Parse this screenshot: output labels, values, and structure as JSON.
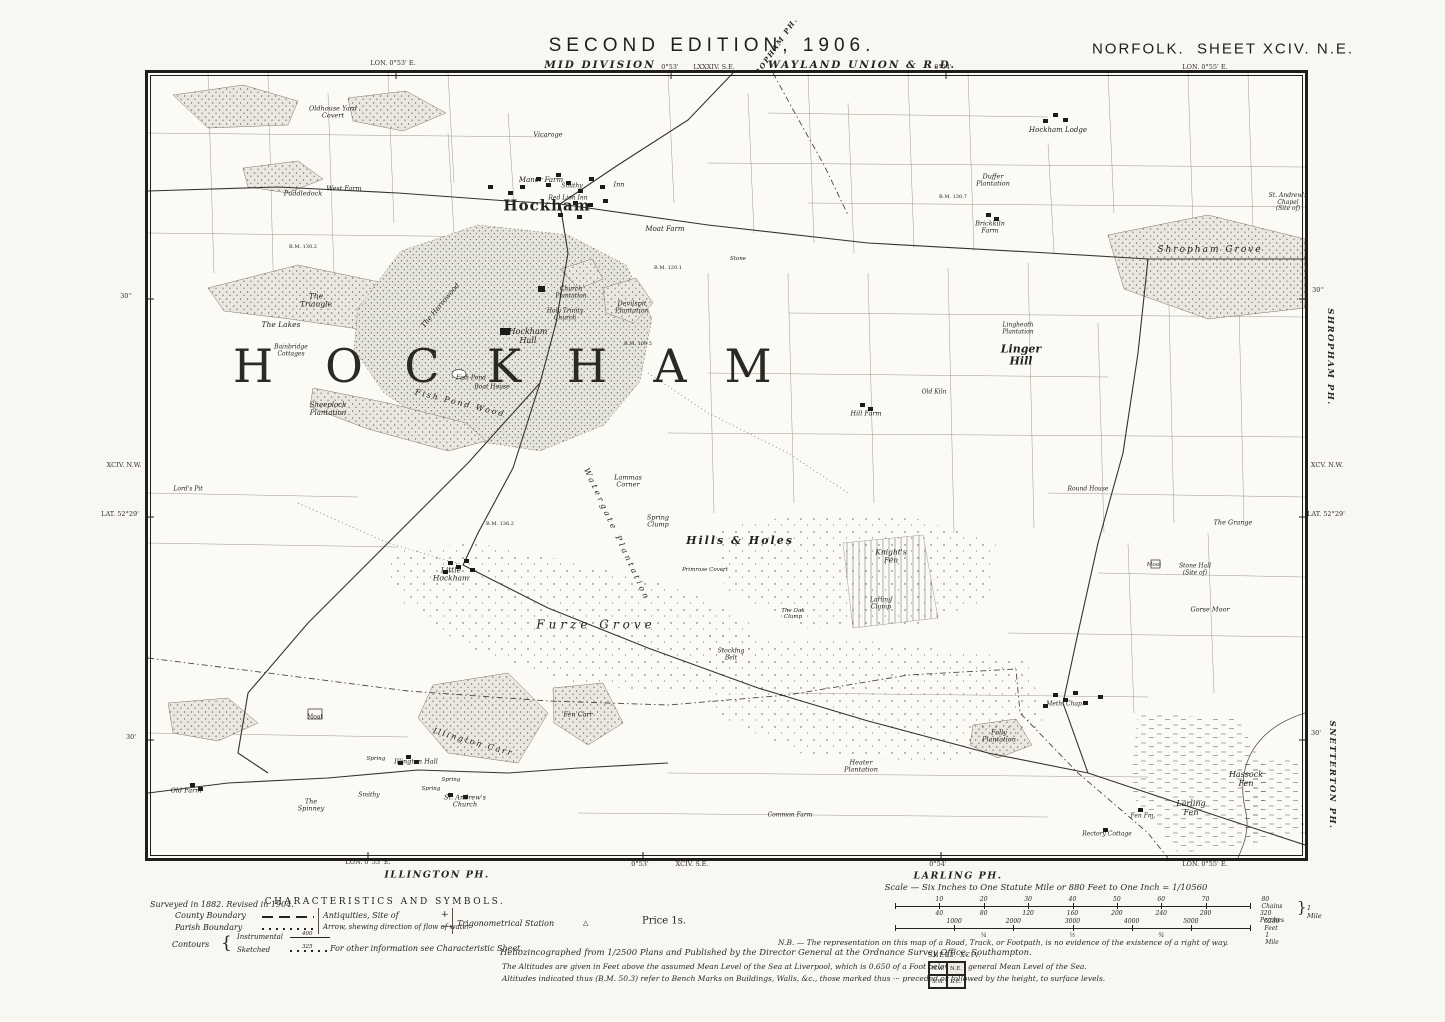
{
  "colors": {
    "paper": "#f8f7f2",
    "ink": "#26241f",
    "wood_fill": "#e9e7e0",
    "park_fill": "#e4e3dc"
  },
  "header": {
    "edition": "SECOND EDITION, 1906.",
    "division": "MID DIVISION",
    "union": "WAYLAND UNION & R.D.",
    "sheet_title": "NORFOLK.  SHEET XCIV. N.E.",
    "adjoining_parish_diagonal": "SHROPHAM PH.",
    "small_sheet_ref": "LXXXIV. S.E.",
    "lon_left": "LON. 0°53' E.",
    "lon_mid": "0°53'",
    "lon_mid2": "0°54'",
    "lon_right": "LON. 0°55' E."
  },
  "margin_left": {
    "tick_top": "30''",
    "sheet_ref": "XCIV. N.W.",
    "lat": "LAT. 52°29'",
    "tick_bottom": "30'"
  },
  "margin_right": {
    "tick_top": "30''",
    "parish_top": "SHROPHAM PH.",
    "sheet_ref": "XCV. N.W.",
    "lat": "LAT. 52°29'",
    "tick_bottom": "30'",
    "parish_bottom": "SNETTERTON PH."
  },
  "margin_bottom": {
    "lon_left": "LON. 0°53' E.",
    "parish_left": "ILLINGTON PH.",
    "lon_mid": "0°53'",
    "sheet_ref": "XCIV. S.E.",
    "lon_mid2": "0°54'",
    "parish_right": "LARLING PH.",
    "lon_right": "LON. 0°55' E.",
    "survey_note": "Surveyed in 1882. Revised in 1904."
  },
  "map": {
    "big_name": {
      "text": "HOCKHAM",
      "letters": [
        "H",
        "O",
        "C",
        "K",
        "H",
        "A",
        "M"
      ],
      "xs": [
        105,
        196,
        274,
        356,
        439,
        522,
        600
      ],
      "y": 293
    },
    "labels": [
      {
        "t": "Oldhouse Yard|Covert",
        "x": 185,
        "y": 40,
        "s": 6.5
      },
      {
        "t": "Puddledock",
        "x": 155,
        "y": 121,
        "s": 6.5
      },
      {
        "t": "West Farm",
        "x": 196,
        "y": 116,
        "s": 6.5
      },
      {
        "t": "Vicarage",
        "x": 400,
        "y": 62,
        "s": 6.5
      },
      {
        "t": "Manor Farm",
        "x": 393,
        "y": 108,
        "s": 7
      },
      {
        "t": "Smithy",
        "x": 424,
        "y": 114,
        "s": 6
      },
      {
        "t": "Red Lion Inn",
        "x": 420,
        "y": 126,
        "s": 6
      },
      {
        "t": "Inn",
        "x": 471,
        "y": 112,
        "s": 6.5
      },
      {
        "t": "Hockham",
        "x": 399,
        "y": 133,
        "s": 15,
        "u": 1,
        "b": 1,
        "ls": 1
      },
      {
        "t": "Moat Farm",
        "x": 517,
        "y": 157,
        "s": 7
      },
      {
        "t": "Stone",
        "x": 590,
        "y": 186,
        "s": 5.5
      },
      {
        "t": "Hockham Lodge",
        "x": 910,
        "y": 58,
        "s": 7
      },
      {
        "t": "Duffer|Plantation",
        "x": 845,
        "y": 108,
        "s": 6.5
      },
      {
        "t": "Brickkiln|Farm",
        "x": 842,
        "y": 155,
        "s": 6.5
      },
      {
        "t": "Shropham Grove",
        "x": 1062,
        "y": 177,
        "s": 9,
        "ls": 2
      },
      {
        "t": "St. Andrew's|Chapel|(Site of)",
        "x": 1140,
        "y": 130,
        "s": 6
      },
      {
        "t": "The|Triangle",
        "x": 168,
        "y": 228,
        "s": 7.5
      },
      {
        "t": "The Lakes",
        "x": 133,
        "y": 252,
        "s": 7.5
      },
      {
        "t": "Bainbridge|Cottages",
        "x": 143,
        "y": 278,
        "s": 6
      },
      {
        "t": "The Harrowood",
        "x": 293,
        "y": 233,
        "s": 7,
        "r": -50
      },
      {
        "t": "Church|Plantation",
        "x": 423,
        "y": 220,
        "s": 6
      },
      {
        "t": "Holy Trinity|Church",
        "x": 417,
        "y": 242,
        "s": 6
      },
      {
        "t": "Devilspit|Plantation",
        "x": 484,
        "y": 235,
        "s": 6.5
      },
      {
        "t": "Hockham|Hall",
        "x": 380,
        "y": 264,
        "s": 8
      },
      {
        "t": "Fish Pond",
        "x": 323,
        "y": 306,
        "s": 6
      },
      {
        "t": "Boat House",
        "x": 344,
        "y": 315,
        "s": 6
      },
      {
        "t": "Fish Pond Wood",
        "x": 312,
        "y": 331,
        "s": 8,
        "r": 14,
        "ls": 2
      },
      {
        "t": "Sheeplock|Plantation",
        "x": 180,
        "y": 337,
        "s": 7
      },
      {
        "t": "Lingheath|Plantation",
        "x": 870,
        "y": 256,
        "s": 6
      },
      {
        "t": "Linger|Hill",
        "x": 873,
        "y": 283,
        "s": 11,
        "b": 1
      },
      {
        "t": "Old Kiln",
        "x": 786,
        "y": 320,
        "s": 6
      },
      {
        "t": "Hill Farm",
        "x": 718,
        "y": 341,
        "s": 6.5
      },
      {
        "t": "Lord's Pit",
        "x": 40,
        "y": 417,
        "s": 6
      },
      {
        "t": "Lammas|Corner",
        "x": 480,
        "y": 409,
        "s": 6.5
      },
      {
        "t": "Spring|Clump",
        "x": 510,
        "y": 449,
        "s": 6.5
      },
      {
        "t": "Watergate Plantation",
        "x": 468,
        "y": 462,
        "s": 8,
        "r": 65,
        "ls": 3
      },
      {
        "t": "Hills & Holes",
        "x": 592,
        "y": 468,
        "s": 11,
        "b": 1,
        "ls": 2
      },
      {
        "t": "Knight's|Fen",
        "x": 743,
        "y": 484,
        "s": 7.5
      },
      {
        "t": "Primrose Covert",
        "x": 557,
        "y": 497,
        "s": 5.5
      },
      {
        "t": "Little|Hockham",
        "x": 303,
        "y": 502,
        "s": 7.5
      },
      {
        "t": "Furze Grove",
        "x": 448,
        "y": 552,
        "s": 12,
        "ls": 4
      },
      {
        "t": "The Oak|Clump",
        "x": 645,
        "y": 541,
        "s": 5.5
      },
      {
        "t": "Larling|Clump",
        "x": 733,
        "y": 531,
        "s": 6
      },
      {
        "t": "Stocking|Belt",
        "x": 583,
        "y": 582,
        "s": 6
      },
      {
        "t": "Gorse Moor",
        "x": 1062,
        "y": 537,
        "s": 6.5
      },
      {
        "t": "Moat",
        "x": 1006,
        "y": 492,
        "s": 5.5
      },
      {
        "t": "Stone Hall|(Site of)",
        "x": 1047,
        "y": 497,
        "s": 6
      },
      {
        "t": "The Grange",
        "x": 1085,
        "y": 450,
        "s": 6.5
      },
      {
        "t": "Round House",
        "x": 940,
        "y": 417,
        "s": 6
      },
      {
        "t": "Moat",
        "x": 167,
        "y": 645,
        "s": 6,
        "u": 1
      },
      {
        "t": "Old Farm",
        "x": 38,
        "y": 718,
        "s": 6.5
      },
      {
        "t": "The|Spinney",
        "x": 163,
        "y": 733,
        "s": 6.5
      },
      {
        "t": "Smithy",
        "x": 221,
        "y": 723,
        "s": 6
      },
      {
        "t": "Illington Hall",
        "x": 268,
        "y": 689,
        "s": 6.5
      },
      {
        "t": "St. Andrew's|Church",
        "x": 317,
        "y": 729,
        "s": 6.5
      },
      {
        "t": "Illington Carr",
        "x": 325,
        "y": 670,
        "s": 8,
        "r": 16,
        "ls": 2
      },
      {
        "t": "Spring",
        "x": 228,
        "y": 686,
        "s": 5.5
      },
      {
        "t": "Spring",
        "x": 303,
        "y": 707,
        "s": 5.5
      },
      {
        "t": "Spring",
        "x": 283,
        "y": 716,
        "s": 5.5
      },
      {
        "t": "Fen Carr",
        "x": 430,
        "y": 642,
        "s": 6.5
      },
      {
        "t": "Folly|Plantation",
        "x": 851,
        "y": 664,
        "s": 6.5
      },
      {
        "t": "Heater|Plantation",
        "x": 713,
        "y": 694,
        "s": 6.5
      },
      {
        "t": "Common Farm",
        "x": 642,
        "y": 743,
        "s": 6
      },
      {
        "t": "Meth. Chap.",
        "x": 917,
        "y": 632,
        "s": 6
      },
      {
        "t": "Hassock|Fen",
        "x": 1098,
        "y": 707,
        "s": 8
      },
      {
        "t": "Larling|Fen",
        "x": 1043,
        "y": 736,
        "s": 8
      },
      {
        "t": "Fen Fm.",
        "x": 995,
        "y": 744,
        "s": 6
      },
      {
        "t": "Rectory Cottage",
        "x": 959,
        "y": 762,
        "s": 6
      },
      {
        "t": "B.M. 130.2",
        "x": 155,
        "y": 175,
        "s": 5,
        "u": 1
      },
      {
        "t": "B.M. 120.1",
        "x": 520,
        "y": 196,
        "s": 5,
        "u": 1
      },
      {
        "t": "B.M. 109.5",
        "x": 490,
        "y": 272,
        "s": 5,
        "u": 1
      },
      {
        "t": "B.M. 130.7",
        "x": 805,
        "y": 125,
        "s": 5,
        "u": 1
      },
      {
        "t": "B.M. 136.2",
        "x": 352,
        "y": 452,
        "s": 5,
        "u": 1
      }
    ]
  },
  "legend": {
    "title": "CHARACTERISTICS AND SYMBOLS.",
    "county": "County Boundary",
    "parish": "Parish Boundary",
    "contours": "Contours",
    "contour_rows": [
      {
        "label": "Instrumental",
        "value": "400"
      },
      {
        "label": "Sketched",
        "value": "325"
      }
    ],
    "antiquities": "Antiquities, Site of",
    "antiquities_symbol": "+",
    "arrow": "Arrow, shewing direction of flow of water",
    "arrow_symbol": "⟶",
    "trig": "Trigonometrical Station",
    "trig_symbol": "△",
    "other_note": "For other information see Characteristic Sheet."
  },
  "price": "Price 1s.",
  "scale_bar": {
    "title": "Scale — Six Inches to One Statute Mile or 880 Feet to One Inch = 1/10560",
    "chains": [
      "10",
      "20",
      "30",
      "40",
      "50",
      "60",
      "70"
    ],
    "chains_end": "80 Chains",
    "perches": [
      "40",
      "80",
      "120",
      "160",
      "200",
      "240",
      "280"
    ],
    "perches_end": "320 Perches",
    "mile_brace": "}",
    "mile_label": "1 Mile",
    "feet": [
      "1000",
      "2000",
      "3000",
      "4000",
      "5000"
    ],
    "feet_end": "5280 Feet",
    "mile_fracs": [
      "¼",
      "½",
      "¾"
    ],
    "mile_end": "1 Mile"
  },
  "notes": {
    "helio": "Heliozincographed from 1/2500 Plans and Published by the Director General at the Ordnance Survey Office, Southampton.",
    "nb": "N.B. — The representation on this map of a Road, Track, or Footpath, is no evidence of the existence of a right of way.",
    "alt1": "The Altitudes are given in Feet above the assumed Mean Level of the Sea at Liverpool, which is 0.650 of a Foot below the general Mean Level of the Sea.",
    "alt2": "Altitudes indicated thus (B.M. 50.3) refer to Bench Marks on Buildings, Walls, &c., those marked thus ··· preceded or followed by the height, to surface levels."
  },
  "sheet_index": {
    "label": "SHEET.",
    "value": "XCIV.",
    "cells": [
      "N.W.",
      "N.E.",
      "S.W.",
      "S.E."
    ]
  }
}
